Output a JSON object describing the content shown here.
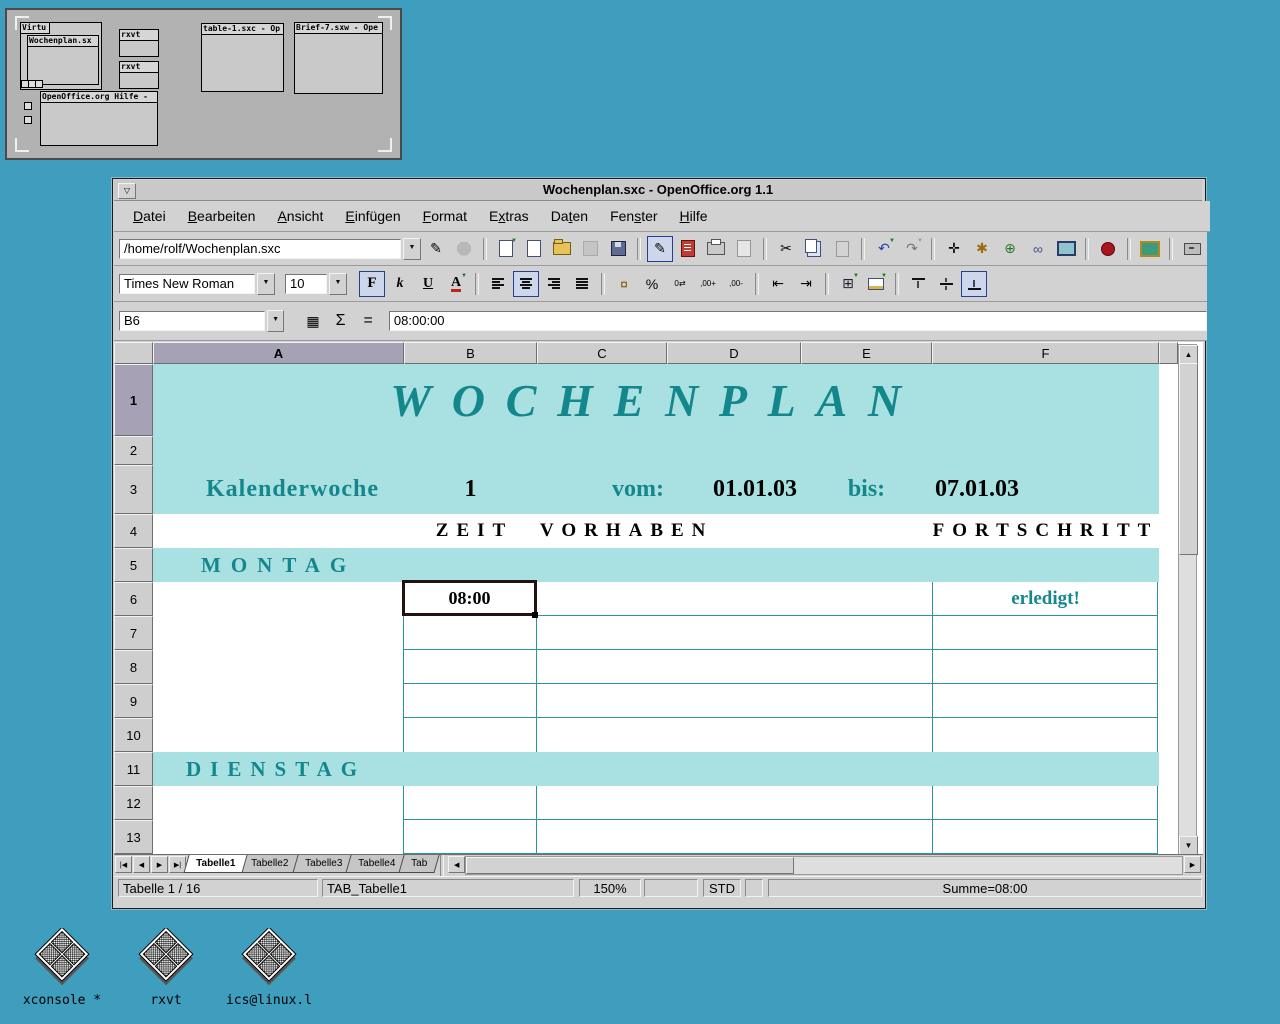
{
  "colors": {
    "desktop_bg": "#3F9DBE",
    "window_chrome": "#d2d2d2",
    "band_teal": "#A9E0E2",
    "accent_teal": "#14878C",
    "grid_teal": "#2D9598",
    "header_highlight": "#A7A1B5"
  },
  "pager": {
    "windows": [
      {
        "title": "Virtu"
      },
      {
        "title": "Wochenplan.sx"
      },
      {
        "title": "rxvt"
      },
      {
        "title": "rxvt"
      },
      {
        "title": "table-1.sxc - Op"
      },
      {
        "title": "Brief-7.sxw - Ope"
      },
      {
        "title": "OpenOffice.org Hilfe -"
      }
    ]
  },
  "window": {
    "title": "Wochenplan.sxc - OpenOffice.org 1.1",
    "menu": [
      {
        "label": "Datei",
        "mnemonic": 0
      },
      {
        "label": "Bearbeiten",
        "mnemonic": 0
      },
      {
        "label": "Ansicht",
        "mnemonic": 0
      },
      {
        "label": "Einfügen",
        "mnemonic": 0
      },
      {
        "label": "Format",
        "mnemonic": 0
      },
      {
        "label": "Extras",
        "mnemonic": 1
      },
      {
        "label": "Daten",
        "mnemonic": 2
      },
      {
        "label": "Fenster",
        "mnemonic": 3
      },
      {
        "label": "Hilfe",
        "mnemonic": 0
      }
    ],
    "url_value": "/home/rolf/Wochenplan.sxc",
    "font_name": "Times New Roman",
    "font_size": "10",
    "cell_reference": "B6",
    "formula_value": "08:00:00"
  },
  "sheet": {
    "column_headers": [
      "A",
      "B",
      "C",
      "D",
      "E",
      "F"
    ],
    "row_headers": [
      "1",
      "2",
      "3",
      "4",
      "5",
      "6",
      "7",
      "8",
      "9",
      "10",
      "11",
      "12",
      "13"
    ],
    "highlighted_column": "A",
    "highlighted_row": "1",
    "cells": {
      "title": "WOCHENPLAN",
      "kalenderwoche_label": "Kalenderwoche",
      "kalenderwoche_value": "1",
      "vom_label": "vom:",
      "vom_value": "01.01.03",
      "bis_label": "bis:",
      "bis_value": "07.01.03",
      "zeit_header": "ZEIT",
      "vorhaben_header": "VORHABEN",
      "fortschritt_header": "FORTSCHRITT",
      "montag_header": "MONTAG",
      "dienstag_header": "DIENSTAG",
      "b6_value": "08:00",
      "f6_value": "erledigt!"
    }
  },
  "sheet_tabs": {
    "tabs": [
      "Tabelle1",
      "Tabelle2",
      "Tabelle3",
      "Tabelle4",
      "Tab"
    ],
    "active": "Tabelle1"
  },
  "statusbar": {
    "sheet_info": "Tabelle 1 / 16",
    "page_style": "TAB_Tabelle1",
    "zoom": "150%",
    "mode": "STD",
    "sum": "Summe=08:00"
  },
  "desktop_icons": [
    {
      "label": "xconsole *"
    },
    {
      "label": "rxvt"
    },
    {
      "label": "ics@linux.l"
    }
  ],
  "icons": {
    "window_menu": "▽",
    "edit_file": "✎",
    "cut": "✂",
    "undo": "↶",
    "redo": "↷",
    "navigator": "✛",
    "stylist": "✱",
    "gallery": "⊕",
    "hyperlink": "∞",
    "bold": "F",
    "italic": "k",
    "underline": "U",
    "font_color": "A",
    "currency": "¤",
    "percent": "%",
    "num_default": "0⇄",
    "num_add": ",00+",
    "num_del": ",00-",
    "indent_less": "⇤",
    "indent_more": "⇥",
    "borders": "⊞",
    "function_wizard": "▦",
    "sum_symbol": "Σ",
    "equals": "=",
    "dropdown": "▼",
    "up_arrow": "▲",
    "down_arrow": "▼",
    "left_arrow": "◀",
    "right_arrow": "▶",
    "tab_first": "|◀",
    "tab_last": "▶|"
  }
}
